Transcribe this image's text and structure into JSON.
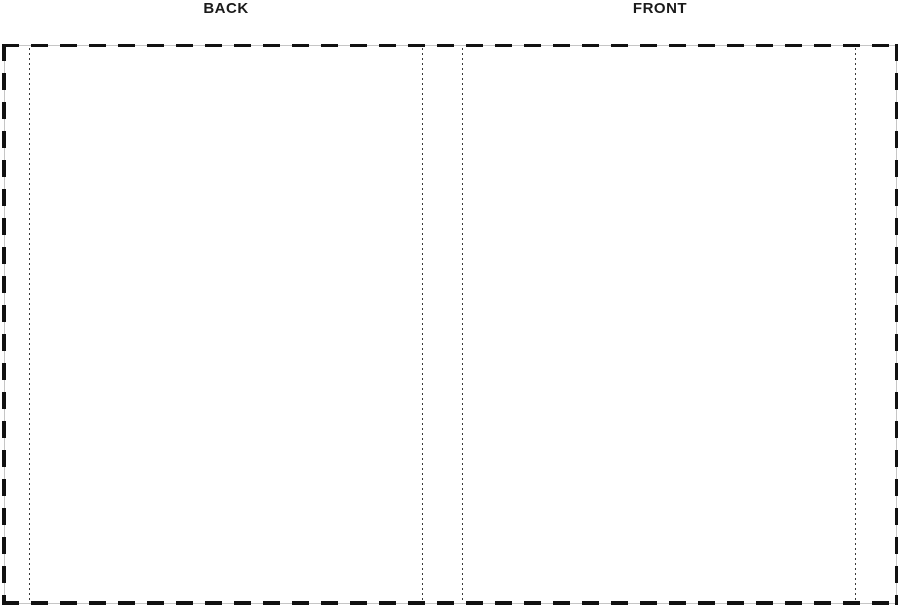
{
  "labels": {
    "back": "BACK",
    "front": "FRONT"
  },
  "colors": {
    "page_bg": "#ffffff",
    "label_text": "#1a1a1a",
    "cut_line": "#111111",
    "cut_line_base": "#c6c6c6",
    "fold_line": "#3a3a3a"
  }
}
